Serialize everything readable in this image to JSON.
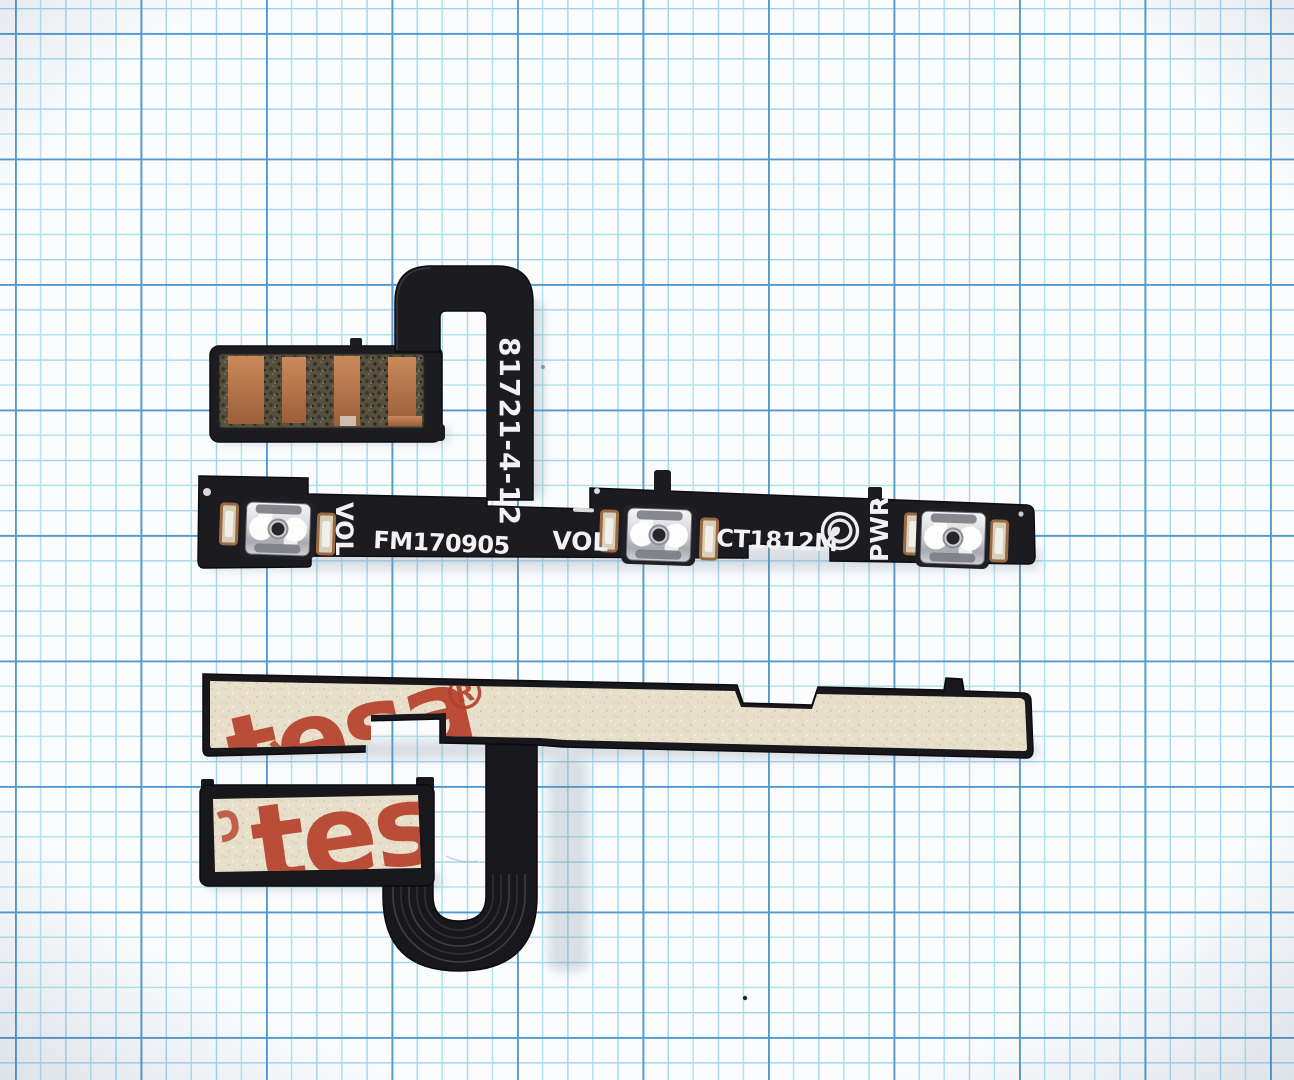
{
  "background": {
    "paper_color": "#fafcfe",
    "grid_minor_color": "#8ecbe9",
    "grid_minor_alt_color": "#9fdde9",
    "grid_major_color": "#4a92cb"
  },
  "top_flex": {
    "serial": "81721-4-12",
    "vol_left": "VOL",
    "batch_code": "FM170905",
    "vol_right": "VOL",
    "model_code": "CT1812M",
    "pwr_label": "PWR",
    "logo_icon": "certification-globe-logo-icon",
    "body_color": "#1b1b20",
    "copper_color": "#b5744a",
    "label_color": "#f2f2f2"
  },
  "bottom_flex": {
    "brand_word": "tesa",
    "brand_reg_mark": "®",
    "brand_word_connector": "tesa",
    "tape_color": "#e8dfca",
    "brand_color": "#b5402c",
    "body_color": "#17171c"
  }
}
